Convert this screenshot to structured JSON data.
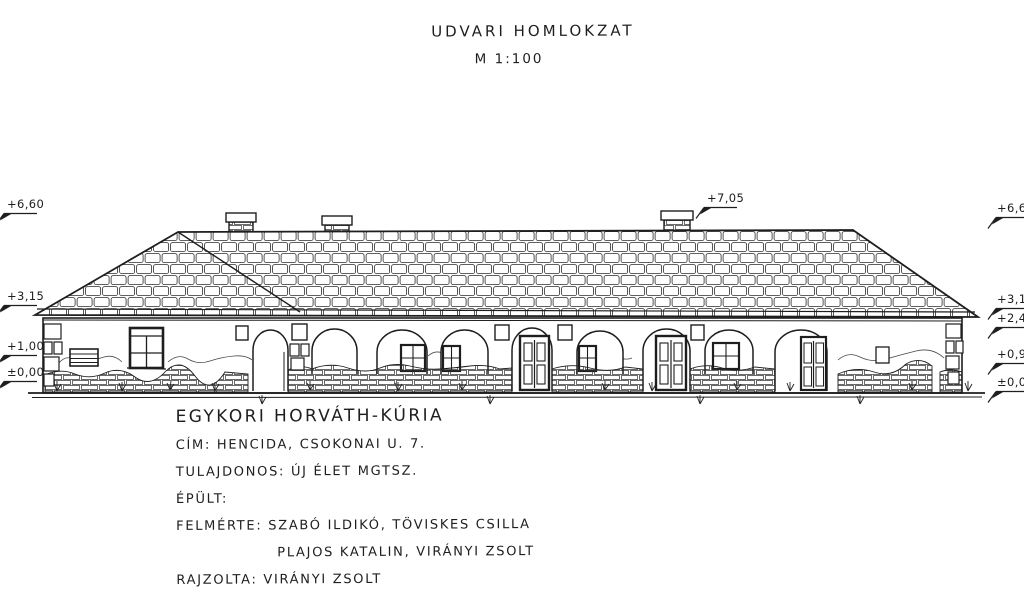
{
  "drawing": {
    "title": "UDVARI HOMLOKZAT",
    "scale": "M 1:100"
  },
  "level_marks": {
    "roof_peak": "+7,05",
    "left": [
      "+6,60",
      "+3,15",
      "+1,00",
      "±0,00"
    ],
    "right": [
      "+6,60",
      "+3,15",
      "+2,40",
      "+0,95",
      "±0,00"
    ]
  },
  "title_block": {
    "building_name": "EGYKORI HORVÁTH-KÚRIA",
    "address_label": "CÍM: HENCIDA, CSOKONAI U. 7.",
    "owner_label": "TULAJDONOS: ÚJ ÉLET MGTSZ.",
    "built_label": "ÉPÜLT:",
    "surveyed_by_line1": "FELMÉRTE: SZABÓ ILDIKÓ, TÖVISKES CSILLA",
    "surveyed_by_line2": "PLAJOS KATALIN, VIRÁNYI ZSOLT",
    "drawn_by_label": "RAJZOLTA: VIRÁNYI ZSOLT"
  },
  "colors": {
    "ink": "#1e1e1e",
    "paper": "#ffffff"
  }
}
